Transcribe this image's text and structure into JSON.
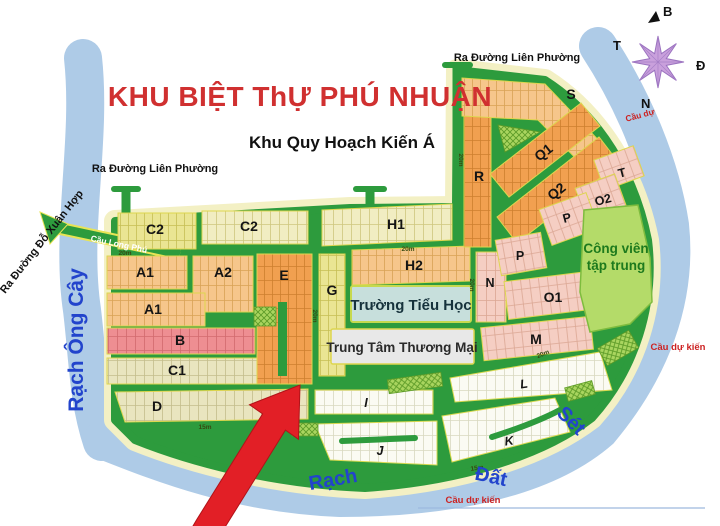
{
  "title": {
    "text": "KHU BIỆT ThỰ PHÚ NHUẬN",
    "color": "#d03030"
  },
  "subtitle": {
    "text": "Khu Quy Hoạch Kiến Á"
  },
  "compass": {
    "north": "B",
    "south": "N",
    "east": "Đ",
    "west": "T"
  },
  "exits": {
    "lien_phuong_west": "Ra Đường Liên Phường",
    "lien_phuong_north": "Ra Đường Liên Phường",
    "do_xuan_hop": "Ra Đường Đỗ Xuân Hợp"
  },
  "bridges": {
    "long_phu": "Cầu Long Phú",
    "du_kien_northeast": "Cầu dự",
    "du_kien_east": "Cầu dự kiến",
    "du_kien_south": "Cầu dự kiến"
  },
  "waterways": {
    "ong_cay": "Rạch Ông Cây",
    "rach": "Rạch",
    "dat": "Đất",
    "set": "Sét"
  },
  "facilities": {
    "school": "Trường Tiểu Học",
    "mall": "Trung Tâm Thương Mại",
    "park_line1": "Công viên",
    "park_line2": "tập trung"
  },
  "blocks": [
    {
      "label": "C2"
    },
    {
      "label": "C2"
    },
    {
      "label": "H1"
    },
    {
      "label": "A1"
    },
    {
      "label": "A2"
    },
    {
      "label": "A1"
    },
    {
      "label": "B"
    },
    {
      "label": "C1"
    },
    {
      "label": "D"
    },
    {
      "label": "E"
    },
    {
      "label": "G"
    },
    {
      "label": "H2"
    },
    {
      "label": "N"
    },
    {
      "label": "R"
    },
    {
      "label": "S"
    },
    {
      "label": "Q1"
    },
    {
      "label": "Q2"
    },
    {
      "label": "T"
    },
    {
      "label": "O2"
    },
    {
      "label": "P"
    },
    {
      "label": "P"
    },
    {
      "label": "O1"
    },
    {
      "label": "M"
    },
    {
      "label": "I"
    },
    {
      "label": "J"
    },
    {
      "label": "K"
    },
    {
      "label": "L"
    }
  ],
  "road_labels": [
    "20m",
    "20m",
    "20m",
    "20m",
    "20m",
    "15m",
    "15m",
    "20m"
  ],
  "colors": {
    "water": "#aecbe7",
    "road_green": "#2d9b3d",
    "road_edge_yellow": "#f3f0c4",
    "park_green": "#b4db69",
    "arrow_red": "#e21f26",
    "compass_purple": "#c9a0dc",
    "river_text_blue": "#2244cc",
    "bridge_text_red": "#cc2222"
  }
}
